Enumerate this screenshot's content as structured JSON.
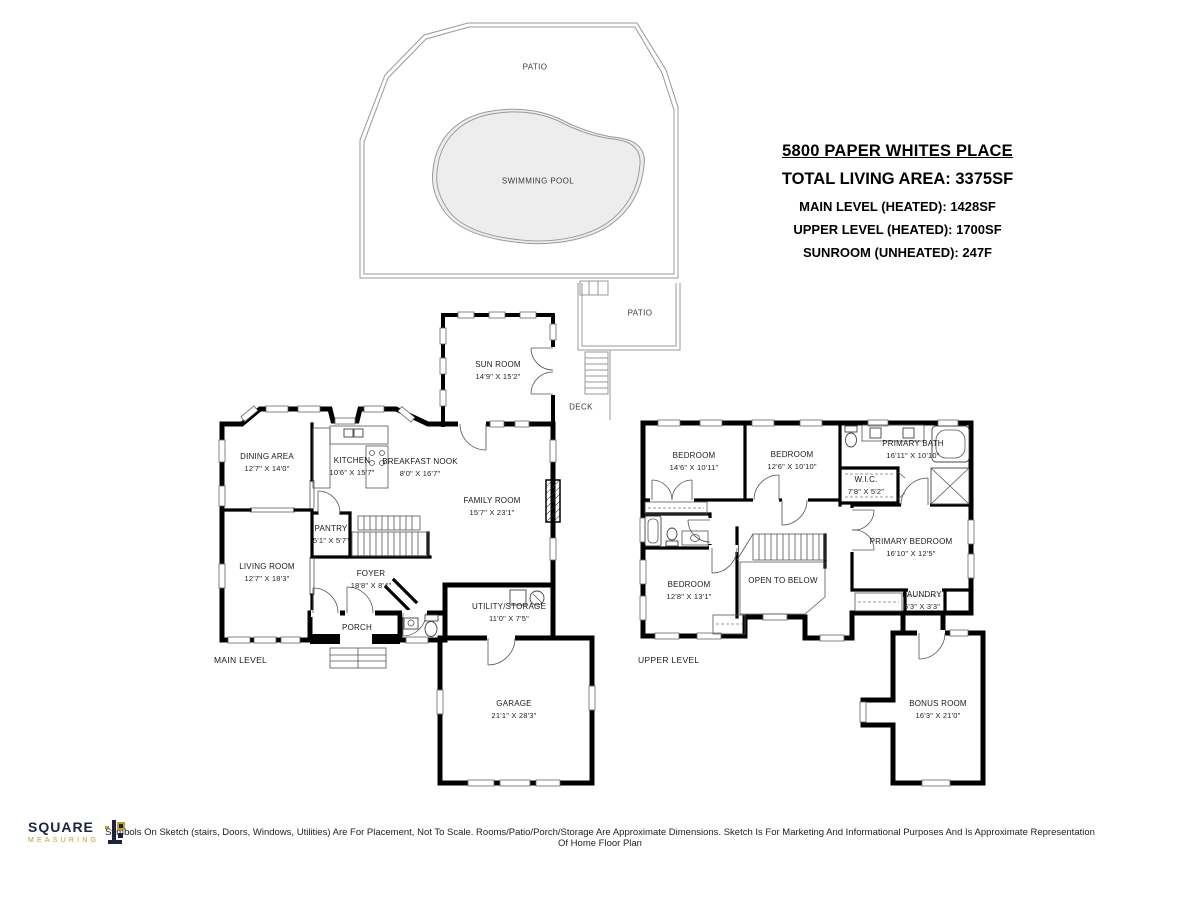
{
  "title_block": {
    "address": "5800 PAPER WHITES PLACE",
    "total": "TOTAL LIVING AREA: 3375SF",
    "main_line": "MAIN LEVEL (HEATED): 1428SF",
    "upper_line": "UPPER LEVEL (HEATED): 1700SF",
    "sunroom_line": "SUNROOM (UNHEATED): 247F"
  },
  "outdoor": {
    "patio_large": "PATIO",
    "swimming_pool": "SWIMMING POOL",
    "patio_small": "PATIO",
    "deck": "DECK"
  },
  "levels": {
    "main_label": "MAIN LEVEL",
    "upper_label": "UPPER LEVEL"
  },
  "rooms": {
    "main": {
      "sun_room": {
        "name": "SUN ROOM",
        "dims": "14'9\" X 15'2\""
      },
      "dining": {
        "name": "DINING AREA",
        "dims": "12'7\" X 14'0\""
      },
      "kitchen": {
        "name": "KITCHEN",
        "dims": "10'6\" X 15'7\""
      },
      "breakfast": {
        "name": "BREAKFAST NOOK",
        "dims": "8'0\" X 16'7\""
      },
      "family": {
        "name": "FAMILY ROOM",
        "dims": "15'7\" X 23'1\""
      },
      "pantry": {
        "name": "PANTRY",
        "dims": "5'1\" X 5'7\""
      },
      "living": {
        "name": "LIVING ROOM",
        "dims": "12'7\" X 18'3\""
      },
      "foyer": {
        "name": "FOYER",
        "dims": "18'8\" X 8'4\""
      },
      "porch": {
        "name": "PORCH"
      },
      "utility": {
        "name": "UTILITY/STORAGE",
        "dims": "11'0\" X 7'5\""
      },
      "garage": {
        "name": "GARAGE",
        "dims": "21'1\" X 28'3\""
      }
    },
    "upper": {
      "bedroom1": {
        "name": "BEDROOM",
        "dims": "14'6\" X 10'11\""
      },
      "bedroom2": {
        "name": "BEDROOM",
        "dims": "12'6\" X 10'10\""
      },
      "primary_bath": {
        "name": "PRIMARY BATH",
        "dims": "16'11\" X 10'10\""
      },
      "wic": {
        "name": "W.I.C.",
        "dims": "7'8\" X 5'2\""
      },
      "primary_bedroom": {
        "name": "PRIMARY BEDROOM",
        "dims": "16'10\" X 12'5\""
      },
      "laundry": {
        "name": "LAUNDRY",
        "dims": "6'3\" X 3'3\""
      },
      "bedroom3": {
        "name": "BEDROOM",
        "dims": "12'8\" X 13'1\""
      },
      "open_below": {
        "name": "OPEN TO BELOW"
      },
      "bonus": {
        "name": "BONUS ROOM",
        "dims": "16'3\" X 21'0\""
      }
    }
  },
  "footer": {
    "logo_primary": "SQUARE",
    "logo_secondary": "MEASURING",
    "disclaimer": "Symbols On Sketch (stairs, Doors, Windows, Utilities) Are For Placement, Not To Scale. Rooms/Patio/Porch/Storage Are Approximate Dimensions. Sketch Is For Marketing And Informational Purposes And Is Approximate Representation Of Home Floor Plan"
  },
  "colors": {
    "wall": "#000000",
    "pool_fill": "#ededed",
    "outline_gray": "#999999",
    "logo_navy": "#1c2240",
    "logo_gold": "#bf9b30"
  }
}
